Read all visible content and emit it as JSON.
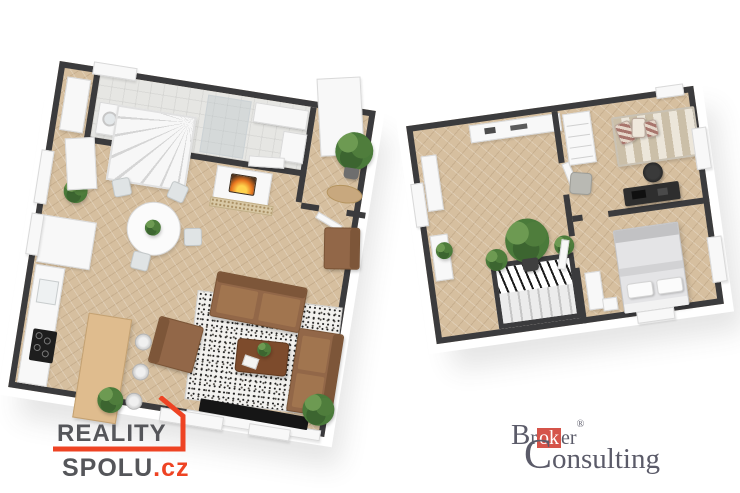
{
  "canvas": {
    "background": "#ffffff"
  },
  "ground_floor_plan": {
    "label": "ground-floor-3d-plan",
    "palette": {
      "wall": "#3b3b3d",
      "wall_face": "#ffffff",
      "floor": "#d6bf9f",
      "bath_floor": "#e6e6e3",
      "sofa": "#926748",
      "coffee_table": "#7d4b2c",
      "kitchen_wood": "#dfbc8e",
      "rug": "#f2f1ee",
      "fire": "#e8761f",
      "plant": "#4a7a3a"
    }
  },
  "upper_floor_plan": {
    "label": "upper-floor-3d-plan",
    "palette": {
      "wall": "#3b3b3d",
      "floor": "#d6bf9f",
      "bed_stripe_a": "#cbbfa8",
      "bed_stripe_b": "#ece6da",
      "master_bed": "#e4e4e6",
      "desk": "#2e2e2e"
    }
  },
  "logos": {
    "reality_spolu": {
      "line1": "REALITY",
      "line2": "SPOLU",
      "tld": ".cz",
      "text_color": "#55565a",
      "accent_color": "#ee4323"
    },
    "broker_consulting": {
      "initial1": "B",
      "seg1": "r",
      "highlight": "ok",
      "seg2": "er",
      "registered": "®",
      "initial2": "C",
      "seg3": "onsulting",
      "text_color": "#5b5b69",
      "highlight_bg": "#d5544a",
      "highlight_text": "#ffffff"
    }
  }
}
